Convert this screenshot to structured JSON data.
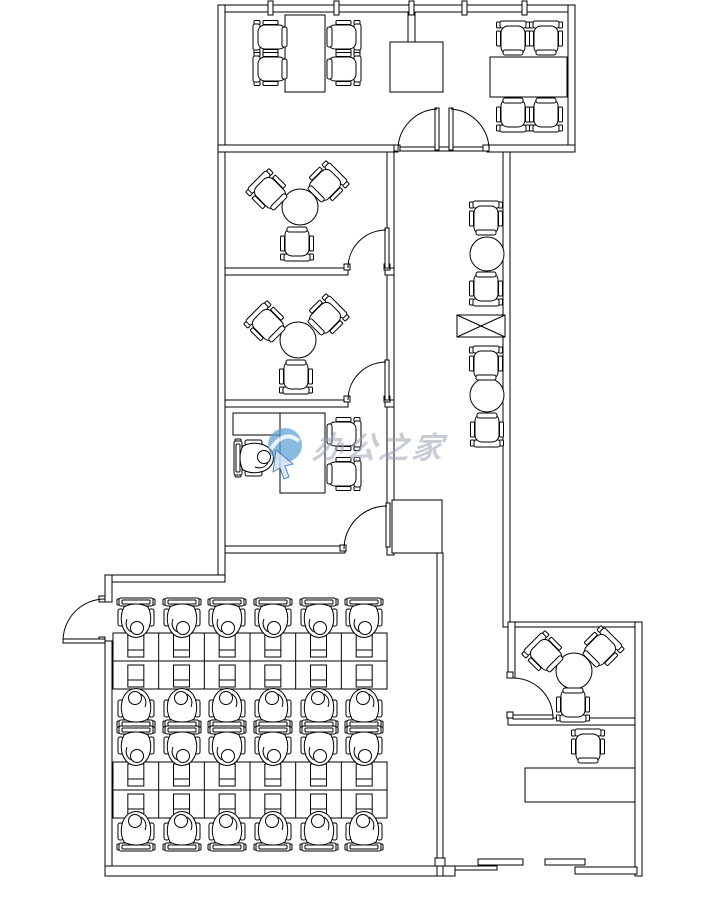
{
  "canvas": {
    "width": 716,
    "height": 898
  },
  "colors": {
    "line": "#000000",
    "background": "#ffffff",
    "watermark_logo": "#5e9fd4",
    "watermark_logo_dark": "#2e6db4",
    "watermark_text": "#97a0b0"
  },
  "watermark": {
    "text": "办公之家"
  },
  "plan": {
    "walls": [
      [
        218,
        5,
        357,
        7,
        "top-wall"
      ],
      [
        218,
        5,
        7,
        577,
        "upper-left-wall"
      ],
      [
        568,
        5,
        7,
        147,
        "upper-right-wall"
      ],
      [
        218,
        145,
        180,
        7,
        "mid-wall-left"
      ],
      [
        487,
        145,
        88,
        7,
        "mid-wall-right"
      ],
      [
        387,
        152,
        7,
        403,
        "rooms-right-wall"
      ],
      [
        503,
        152,
        7,
        475,
        "corridor-right-wall"
      ],
      [
        225,
        268,
        123,
        7,
        "room-a-bottom-wall"
      ],
      [
        385,
        268,
        9,
        7,
        "room-a-bottom-wall-right"
      ],
      [
        225,
        400,
        123,
        7,
        "room-b-bottom-wall"
      ],
      [
        385,
        400,
        9,
        7,
        "room-b-bottom-wall-right"
      ],
      [
        225,
        546,
        120,
        7,
        "room-c-bottom-wall"
      ],
      [
        105,
        575,
        120,
        7,
        "office-top-wall"
      ],
      [
        105,
        575,
        7,
        27,
        "office-left-wall-upper"
      ],
      [
        105,
        641,
        7,
        235,
        "office-left-wall-lower"
      ],
      [
        105,
        866,
        350,
        10,
        "office-bottom-wall"
      ],
      [
        437,
        553,
        6,
        323,
        "office-right-wall"
      ],
      [
        508,
        622,
        134,
        5,
        "lounge-top-wall"
      ],
      [
        508,
        718,
        134,
        7,
        "lounge-bottom-wall"
      ],
      [
        508,
        622,
        7,
        56,
        "lounge-left-wall"
      ],
      [
        635,
        622,
        7,
        254,
        "right-outer-wall"
      ],
      [
        455,
        866,
        42,
        4,
        "entry-ledge"
      ],
      [
        478,
        859,
        45,
        6,
        "entry-panel-a"
      ],
      [
        545,
        859,
        40,
        6,
        "entry-panel-b"
      ],
      [
        575,
        867,
        62,
        7,
        "entry-lower-wall"
      ],
      [
        435,
        858,
        10,
        8,
        "entry-post"
      ],
      [
        408,
        12,
        7,
        30,
        "vestibule-stub-wall"
      ],
      [
        398,
        147,
        91,
        4,
        "double-door-threshold"
      ]
    ],
    "ticks": [
      268,
      334,
      409,
      462,
      522
    ],
    "jambs": [
      [
        394,
        145
      ],
      [
        483,
        145
      ],
      [
        344,
        264
      ],
      [
        384,
        264
      ],
      [
        344,
        396
      ],
      [
        384,
        396
      ],
      [
        340,
        545
      ],
      [
        99,
        596
      ],
      [
        99,
        637
      ],
      [
        507,
        672
      ],
      [
        507,
        712
      ]
    ],
    "rect_tables": [
      [
        285,
        15,
        40,
        77,
        "meeting-table"
      ],
      [
        490,
        57,
        77,
        40,
        "meeting-table"
      ],
      [
        525,
        768,
        110,
        34,
        "reception-desk"
      ],
      [
        280,
        413,
        45,
        80,
        "manager-desk"
      ],
      [
        233,
        413,
        47,
        22,
        "manager-desk-return"
      ]
    ],
    "cabinets": [
      [
        390,
        42,
        53,
        50,
        "vestibule-cabinet"
      ],
      [
        392,
        500,
        50,
        53,
        "storage-cabinet"
      ]
    ],
    "round_tables": [
      [
        300,
        207,
        18
      ],
      [
        298,
        340,
        18
      ],
      [
        574,
        671,
        18
      ],
      [
        487,
        254,
        17
      ],
      [
        487,
        395,
        17
      ]
    ],
    "chairs": [
      [
        272,
        37,
        270
      ],
      [
        272,
        69,
        270
      ],
      [
        342,
        37,
        90
      ],
      [
        342,
        69,
        90
      ],
      [
        513,
        40,
        0
      ],
      [
        546,
        40,
        0
      ],
      [
        513,
        113,
        180
      ],
      [
        546,
        113,
        180
      ],
      [
        270,
        193,
        315
      ],
      [
        325,
        185,
        45
      ],
      [
        297,
        242,
        180
      ],
      [
        268,
        325,
        315
      ],
      [
        325,
        318,
        45
      ],
      [
        296,
        375,
        180
      ],
      [
        546,
        655,
        315
      ],
      [
        600,
        650,
        45
      ],
      [
        573,
        703,
        180
      ],
      [
        486,
        220,
        0
      ],
      [
        486,
        287,
        180
      ],
      [
        486,
        365,
        0
      ],
      [
        487,
        428,
        180
      ],
      [
        342,
        434,
        90
      ],
      [
        342,
        474,
        90
      ],
      [
        588,
        748,
        0
      ]
    ],
    "work_chairs": [
      [
        136,
        621,
        0
      ],
      [
        182,
        621,
        0
      ],
      [
        227,
        621,
        0
      ],
      [
        273,
        621,
        0
      ],
      [
        319,
        621,
        0
      ],
      [
        364,
        621,
        0
      ],
      [
        136,
        705,
        180
      ],
      [
        182,
        705,
        180
      ],
      [
        227,
        705,
        180
      ],
      [
        273,
        705,
        180
      ],
      [
        319,
        705,
        180
      ],
      [
        364,
        705,
        180
      ],
      [
        136,
        749,
        0
      ],
      [
        182,
        749,
        0
      ],
      [
        227,
        749,
        0
      ],
      [
        273,
        749,
        0
      ],
      [
        319,
        749,
        0
      ],
      [
        364,
        749,
        0
      ],
      [
        136,
        828,
        180
      ],
      [
        182,
        828,
        180
      ],
      [
        227,
        828,
        180
      ],
      [
        273,
        828,
        180
      ],
      [
        319,
        828,
        180
      ],
      [
        364,
        828,
        180
      ],
      [
        257,
        458,
        270
      ]
    ],
    "desk_grids": [
      {
        "x": 113,
        "y": 633,
        "cols": 6,
        "rows": 2,
        "cw": 45.67,
        "ch": 28
      },
      {
        "x": 113,
        "y": 762,
        "cols": 6,
        "rows": 2,
        "cw": 45.67,
        "ch": 28
      }
    ],
    "planter": [
      457,
      315,
      48,
      22
    ],
    "doors": [
      {
        "leaf": [
          435,
          108,
          4,
          42
        ],
        "arc": "M 398,150 A 41,41 0 0 1 437,109",
        "name": "double-door-left-leaf"
      },
      {
        "leaf": [
          449,
          108,
          4,
          42
        ],
        "arc": "M 489,150 A 41,41 0 0 0 451,109",
        "name": "double-door-right-leaf"
      },
      {
        "leaf": [
          385,
          228,
          4,
          40
        ],
        "arc": "M 348,268 A 38,38 0 0 1 386,230",
        "name": "room-a-door"
      },
      {
        "leaf": [
          385,
          360,
          4,
          40
        ],
        "arc": "M 348,400 A 38,38 0 0 1 386,362",
        "name": "room-b-door"
      },
      {
        "leaf": [
          386,
          503,
          4,
          44
        ],
        "arc": "M 344,549 A 43,43 0 0 1 387,506",
        "name": "room-c-door"
      },
      {
        "leaf": [
          63,
          639,
          42,
          4
        ],
        "arc": "M 63,641 A 42,42 0 0 1 105,599",
        "name": "entrance-door"
      },
      {
        "leaf": [
          513,
          715,
          40,
          4
        ],
        "arc": "M 513,678 A 40,40 0 0 1 553,718",
        "name": "lounge-door"
      }
    ]
  }
}
